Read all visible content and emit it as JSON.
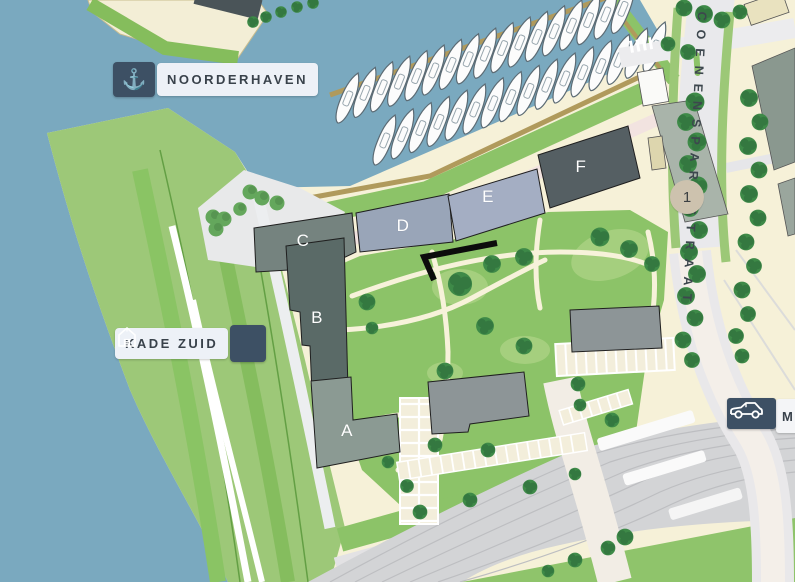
{
  "title": "Noorderhaven development area map",
  "badges": {
    "noorderhaven": {
      "label": "NOORDERHAVEN",
      "icon": "anchor-icon",
      "glyph": "⚓"
    },
    "kade_zuid": {
      "label": "KADE ZUID",
      "icon": "warehouse-icon"
    },
    "mobility": {
      "label": "M",
      "icon": "car-icon"
    }
  },
  "street": {
    "name": "COENENSPARKSTRAAT"
  },
  "buildings": {
    "a": "A",
    "b": "B",
    "c": "C",
    "d": "D",
    "e": "E",
    "f": "F"
  },
  "markers": {
    "one": "1"
  },
  "colors": {
    "water": "#7aa9bf",
    "embankment_green": "#9dc878",
    "park_green": "#8cc368",
    "ground_cream": "#f6f1d8",
    "badge_dark": "#3d5064",
    "badge_light": "#edf1f7",
    "building_dark": "#555f63",
    "building_slate": "#5a6a67",
    "building_blue": "#99a5b8",
    "building_blue_light": "#a4aec3",
    "building_gray_green": "#8b9a93",
    "rail_gray": "#d3d4d6",
    "tree_green": "#3e8a48",
    "promenade_pink": "#f2e3e0",
    "dock_tan": "#b09a5c",
    "marker_beige": "#cdc2ae",
    "annotation_black": "#0c0c0c"
  }
}
